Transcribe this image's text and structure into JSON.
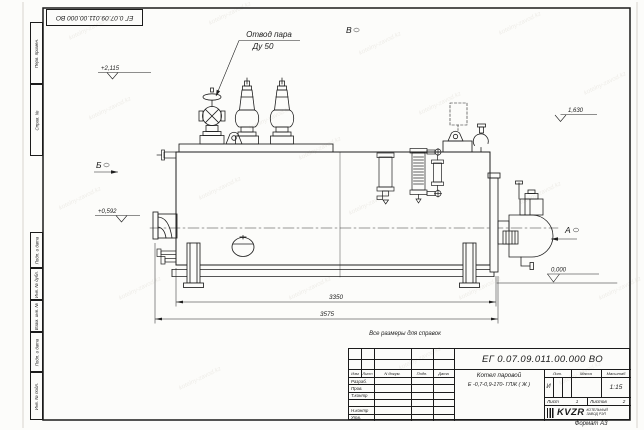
{
  "sheet": {
    "format_note": "Формат А3",
    "reference_note": "Все размеры для справок"
  },
  "doc": {
    "number": "ЕГ 0.07.09.011.00.000  ВО"
  },
  "side_columns": [
    {
      "label": "Перв. примен."
    },
    {
      "label": "Справ. №"
    },
    {
      "label": "Подп. и дата"
    },
    {
      "label": "Инв. № дубл."
    },
    {
      "label": "Взам. инв. №"
    },
    {
      "label": "Подп. и дата"
    },
    {
      "label": "Инв. № подл."
    }
  ],
  "title_block": {
    "product_line1": "Котел паровой",
    "product_line2": "Е -0,7-0,9-170- ГЛЖ ( Ж )",
    "col_izm": "Изм",
    "col_list": "Лист",
    "col_ndoc": "N докум.",
    "col_podp": "Подп.",
    "col_data": "Дата",
    "rows": [
      {
        "label": "Разраб."
      },
      {
        "label": "Пров."
      },
      {
        "label": "Т.контр"
      },
      {
        "label": ""
      },
      {
        "label": "Н.контр"
      },
      {
        "label": "Утв."
      }
    ],
    "col_lit": "Лит.",
    "col_massa": "Масса",
    "col_masshtab": "Масштаб",
    "lit_value": "И",
    "scale_value": "1:15",
    "list_label": "Лист",
    "list_value": "1",
    "listov_label": "Листов",
    "listov_value": "2",
    "company_logo": "KVZR",
    "company_line1": "КОТЕЛЬНЫЙ",
    "company_line2": "ЗАВОД РЭП"
  },
  "annotations": {
    "steam_outlet_line1": "Отвод пара",
    "steam_outlet_line2": "Ду 50",
    "view_top": "В",
    "view_left": "Б",
    "view_right": "А",
    "elev_1": "+2,115",
    "elev_2": "+0,592",
    "elev_3": "1,630",
    "elev_4": "0,000",
    "dim_body": "3350",
    "dim_overall": "3575"
  },
  "watermark": {
    "text": "kotelny-zavod.kz"
  }
}
